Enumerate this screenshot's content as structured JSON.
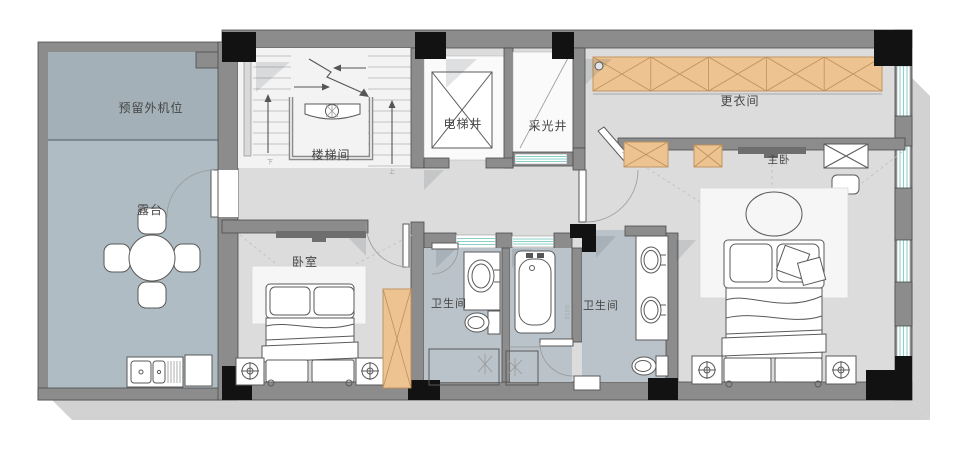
{
  "plan": {
    "rooms": {
      "reserved_ac_unit": {
        "label": "预留外机位"
      },
      "terrace": {
        "label": "露台"
      },
      "stairwell": {
        "label": "楼梯间"
      },
      "elevator_shaft": {
        "label": "电梯井"
      },
      "light_well": {
        "label": "采光井"
      },
      "dressing_room": {
        "label": "更衣间"
      },
      "master_bedroom": {
        "label": "主卧"
      },
      "bedroom": {
        "label": "卧室"
      },
      "bathroom_1": {
        "label": "卫生间"
      },
      "bathroom_2": {
        "label": "卫生间"
      }
    },
    "annotations": {
      "stair_down": "下",
      "stair_up": "上",
      "dimension": "5100"
    },
    "colors": {
      "wall": "#8c8c8c",
      "wall_edge": "#4c4c4c",
      "column": "#121212",
      "terrace_floor": "#afbcc3",
      "ac_floor": "#a3b0b8",
      "interior_floor": "#dcdcdc",
      "stair_floor": "#f3f3f3",
      "bath_floor": "#b9c3c9",
      "wardrobe_fill": "#edc392",
      "wardrobe_line": "#bf9059",
      "glass": "#8ad0ca",
      "furniture_line": "#5a5a5a",
      "shadow": "#d2d2d2",
      "label": "#454545"
    }
  }
}
